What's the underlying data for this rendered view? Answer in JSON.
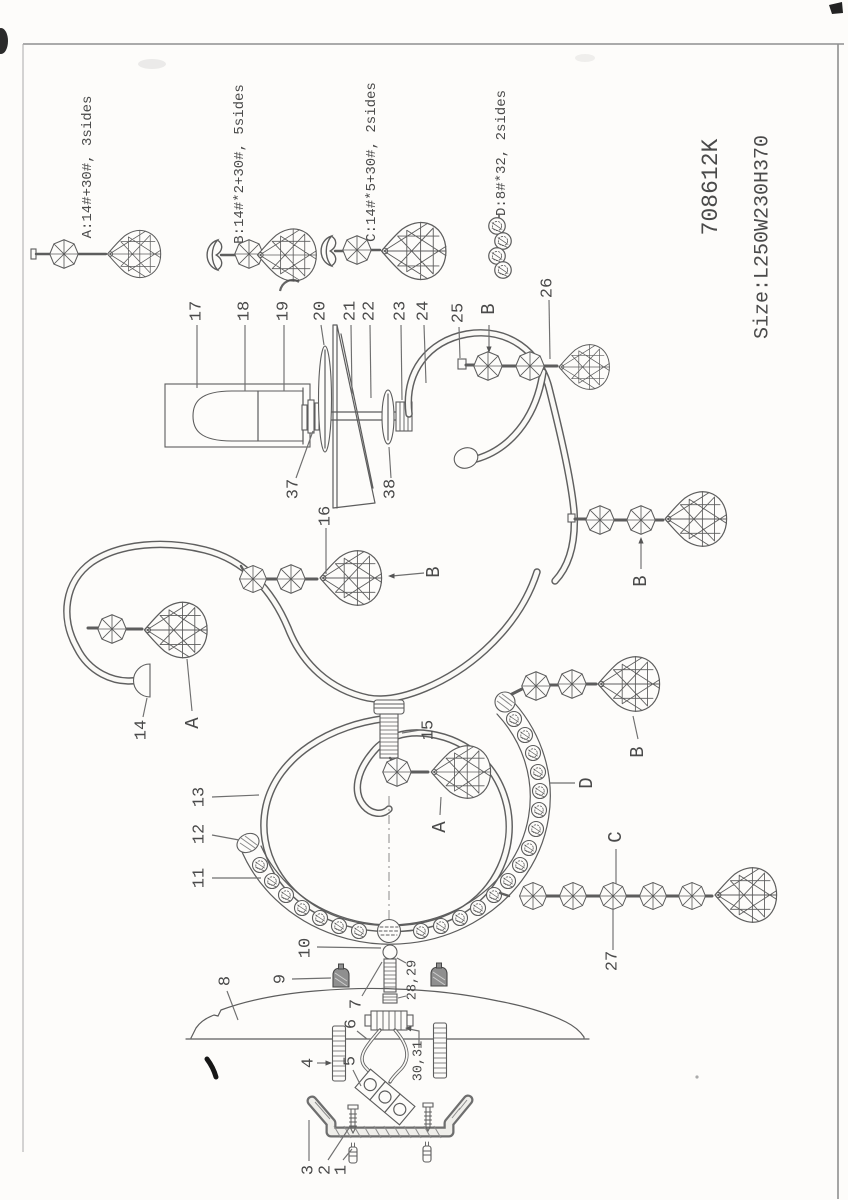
{
  "document": {
    "model_number": "708612K",
    "size_text": "Size:L250W230H370"
  },
  "legend": {
    "item_a": "A:14#+30#, 3sides",
    "item_b": "B:14#*2+30#, 5sides",
    "item_c": "C:14#*5+30#, 2sides",
    "item_d": "D:8#*32, 2sides"
  },
  "callouts": {
    "n1": "1",
    "n2": "2",
    "n3": "3",
    "n4": "4",
    "n5": "5",
    "n6": "6",
    "n7": "7",
    "n8": "8",
    "n9": "9",
    "n10": "10",
    "n11": "11",
    "n12": "12",
    "n13": "13",
    "n14": "14",
    "n15": "15",
    "n16": "16",
    "n17": "17",
    "n18": "18",
    "n19": "19",
    "n20": "20",
    "n21": "21",
    "n22": "22",
    "n23": "23",
    "n24": "24",
    "n25": "25",
    "n26": "26",
    "n27": "27",
    "n2829": "28,29",
    "n3031": "30,31",
    "n37": "37",
    "n38": "38",
    "type_a": "A",
    "type_b": "B",
    "type_c": "C",
    "type_d": "D"
  }
}
